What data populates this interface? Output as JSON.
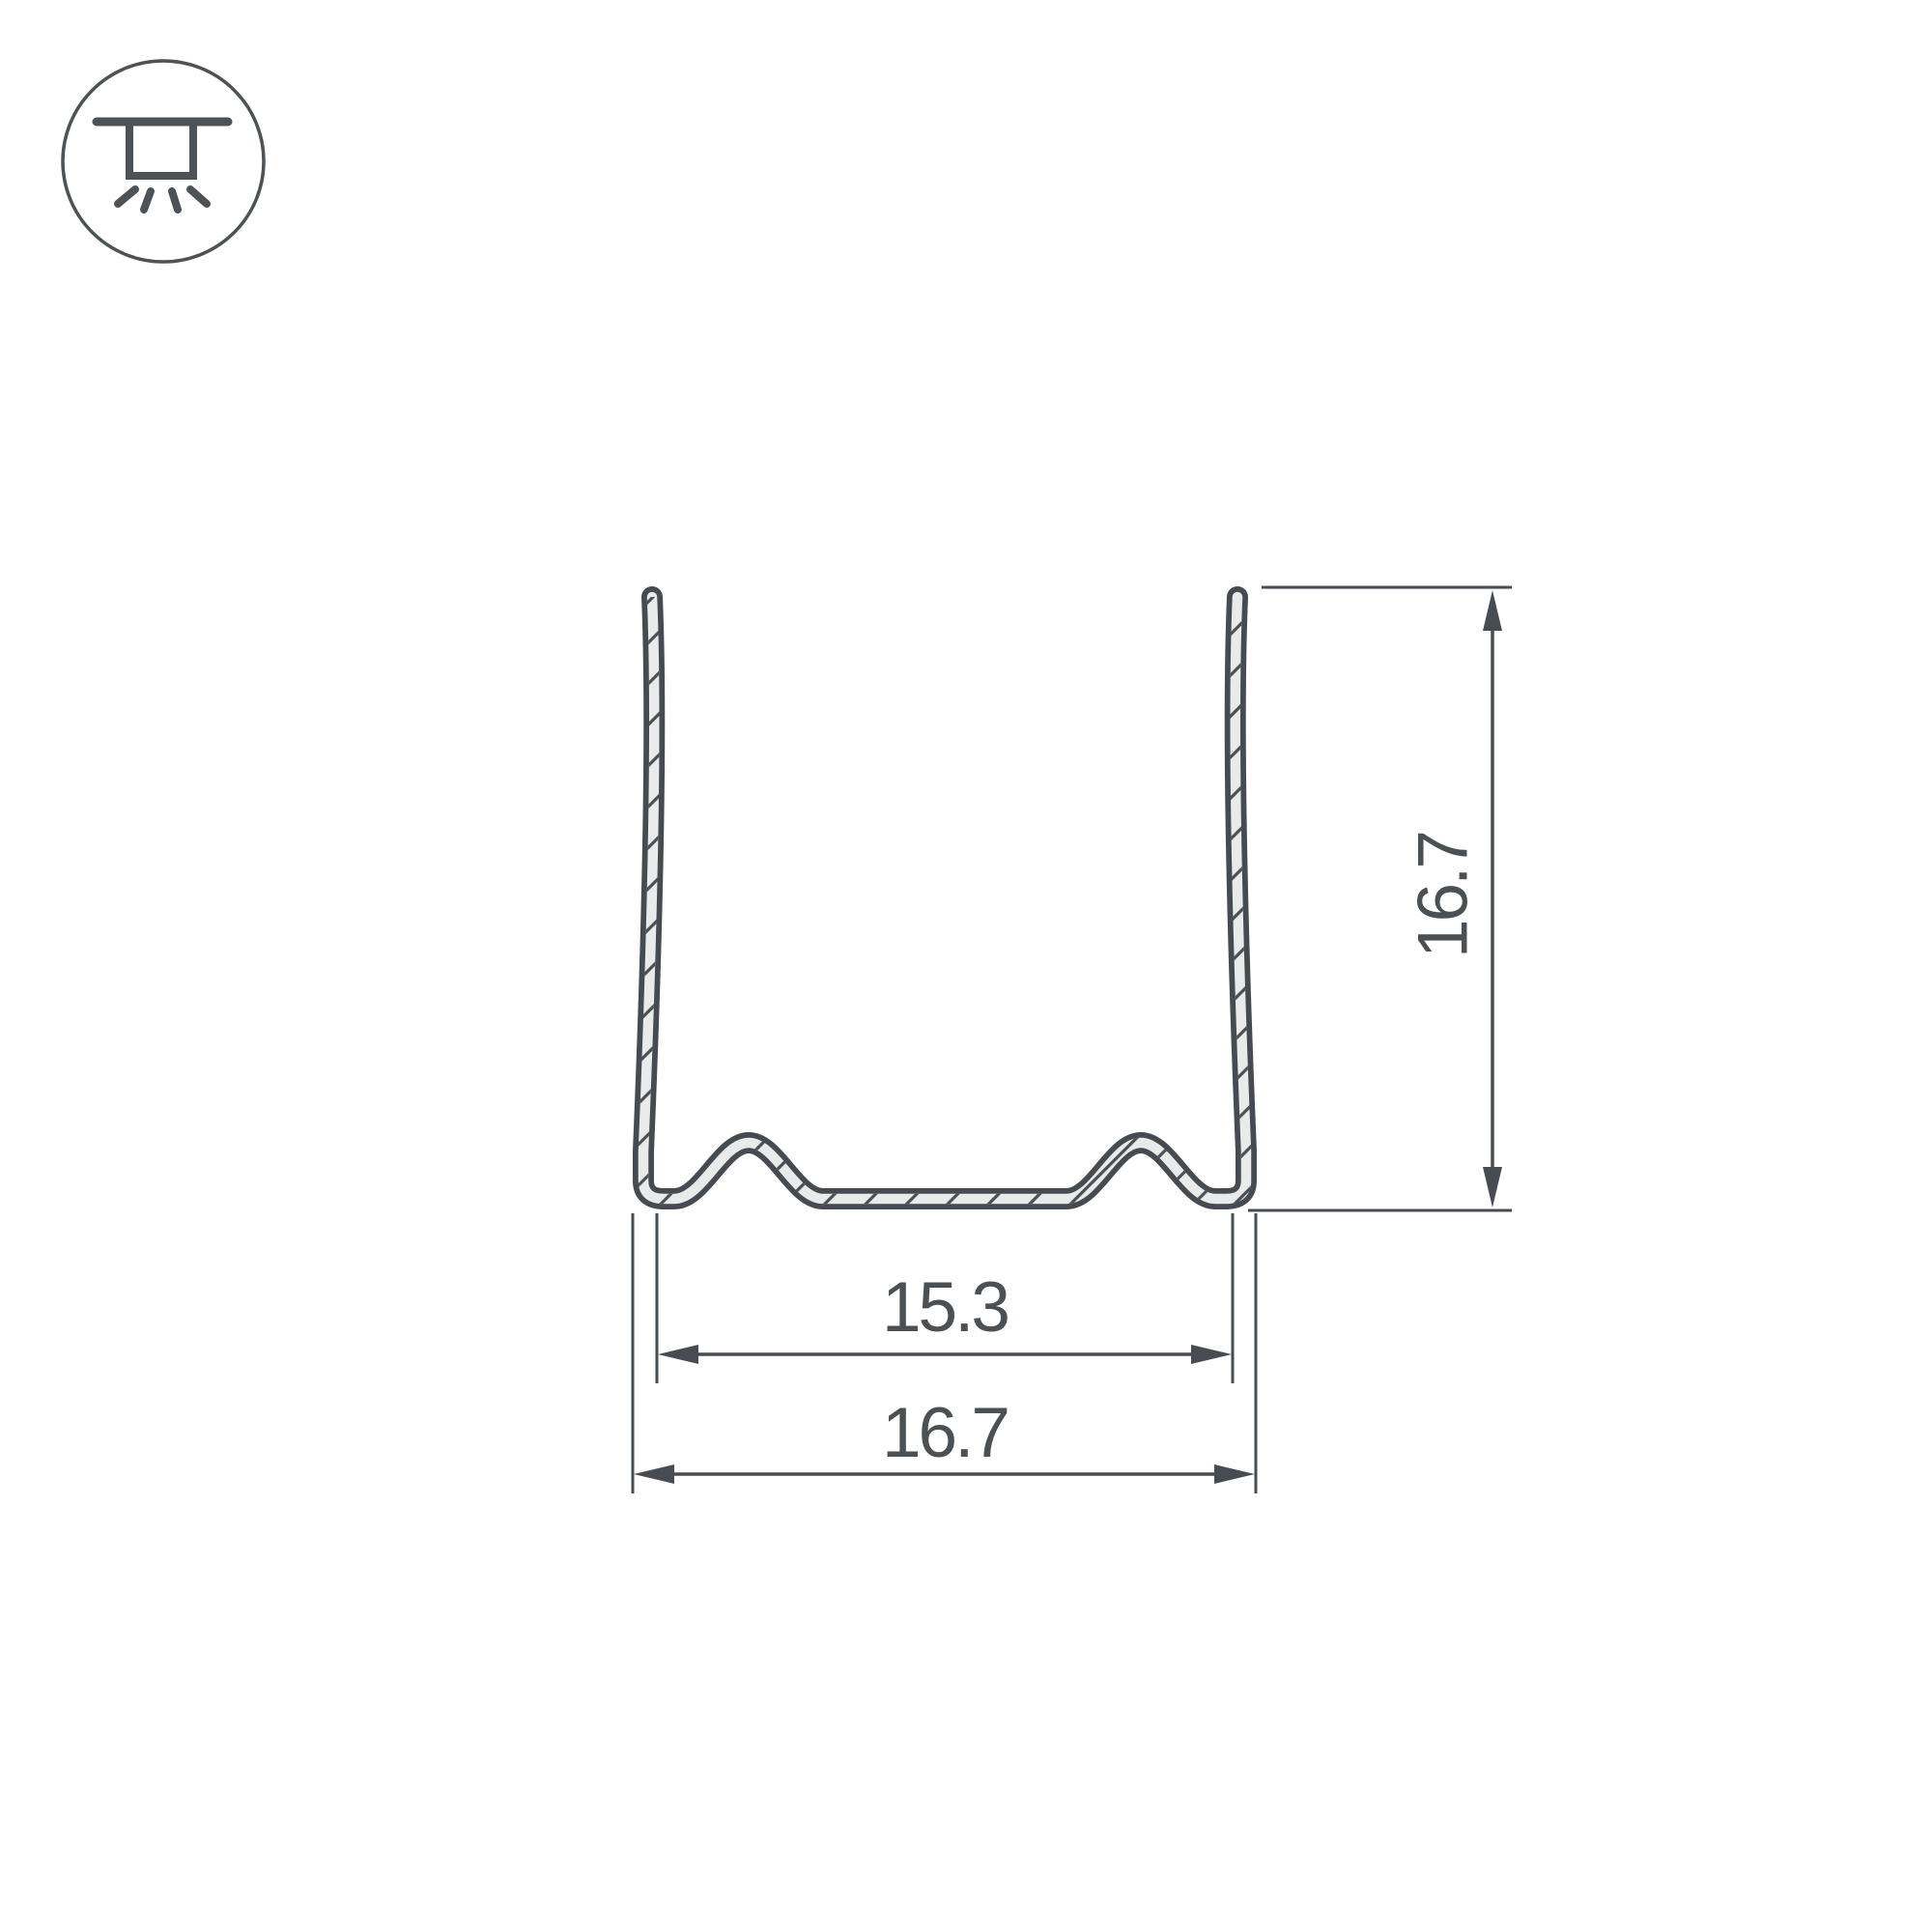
{
  "drawing": {
    "dimensions": {
      "inner_width": "15.3",
      "outer_width": "16.7",
      "height": "16.7"
    }
  },
  "icon": {
    "name": "recessed-ceiling-light",
    "meaning": "ceiling-mounted luminaire shining downward"
  },
  "colors": {
    "line": "#464b51",
    "dimension_line": "#474c52",
    "text": "#4b5055",
    "profile_fill": "#e9eaea",
    "background": "#ffffff"
  }
}
